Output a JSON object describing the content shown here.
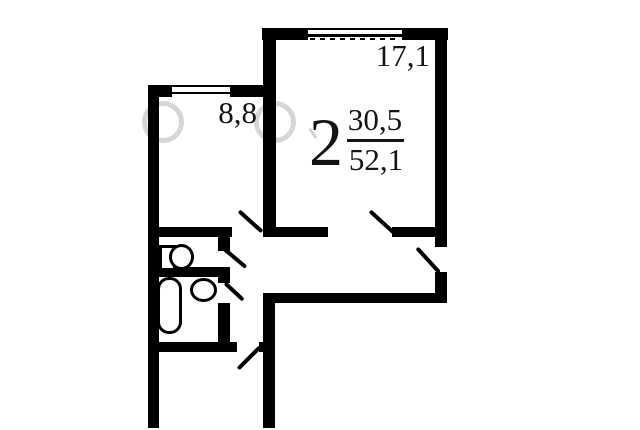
{
  "apartment": {
    "rooms_count": "2",
    "living_area": "30,5",
    "total_area": "52,1"
  },
  "rooms": {
    "living": {
      "area": "17,1"
    },
    "bedroom": {
      "area": "8,8"
    }
  },
  "fixtures": {
    "toilet": "toilet-icon",
    "bathtub": "bathtub-icon",
    "sink": "sink-icon"
  },
  "colors": {
    "wall": "#000000",
    "background": "#ffffff",
    "watermark": "#999999"
  }
}
